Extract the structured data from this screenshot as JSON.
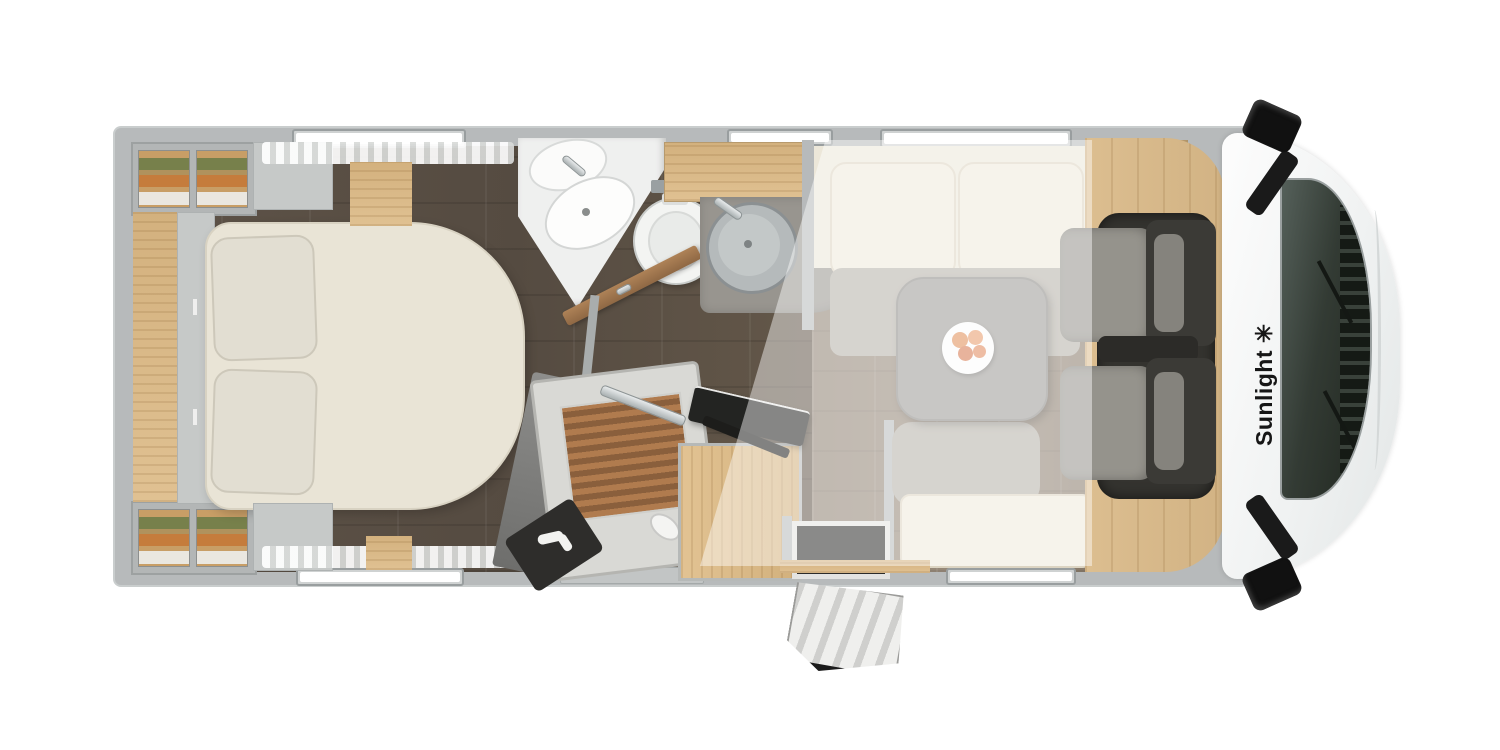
{
  "brand": {
    "label": "Sunlight",
    "logo_glyph": "✳",
    "logo_icon": "sun-star-icon"
  },
  "palette": {
    "background": "#ffffff",
    "wall_gray": "#b7babb",
    "wall_outline": "#9aa0a1",
    "floor_dark_wood": "#5a5046",
    "floor_living_wood": "#8f8173",
    "furniture_wood_light": "#dfc08f",
    "cab_floor_wood": "#d8ba8c",
    "bed_cream": "#e9e4d6",
    "upholstery_cream": "#efe9da",
    "upholstery_gray": "#b5b1a8",
    "table_gray": "#9c9a96",
    "cab_seat_gray": "#96948d",
    "cab_seat_dark": "#3a3936",
    "hood_white": "#fafbfb",
    "windshield_dark": "#323a32",
    "mirror_black": "#161616",
    "clothes_green": "#77804b",
    "clothes_orange": "#c57c3c",
    "fruit_orange": "#e08c54",
    "logo_text": "#1a1a1a",
    "skylight_overlay": "rgba(255,255,255,0.45)"
  }
}
